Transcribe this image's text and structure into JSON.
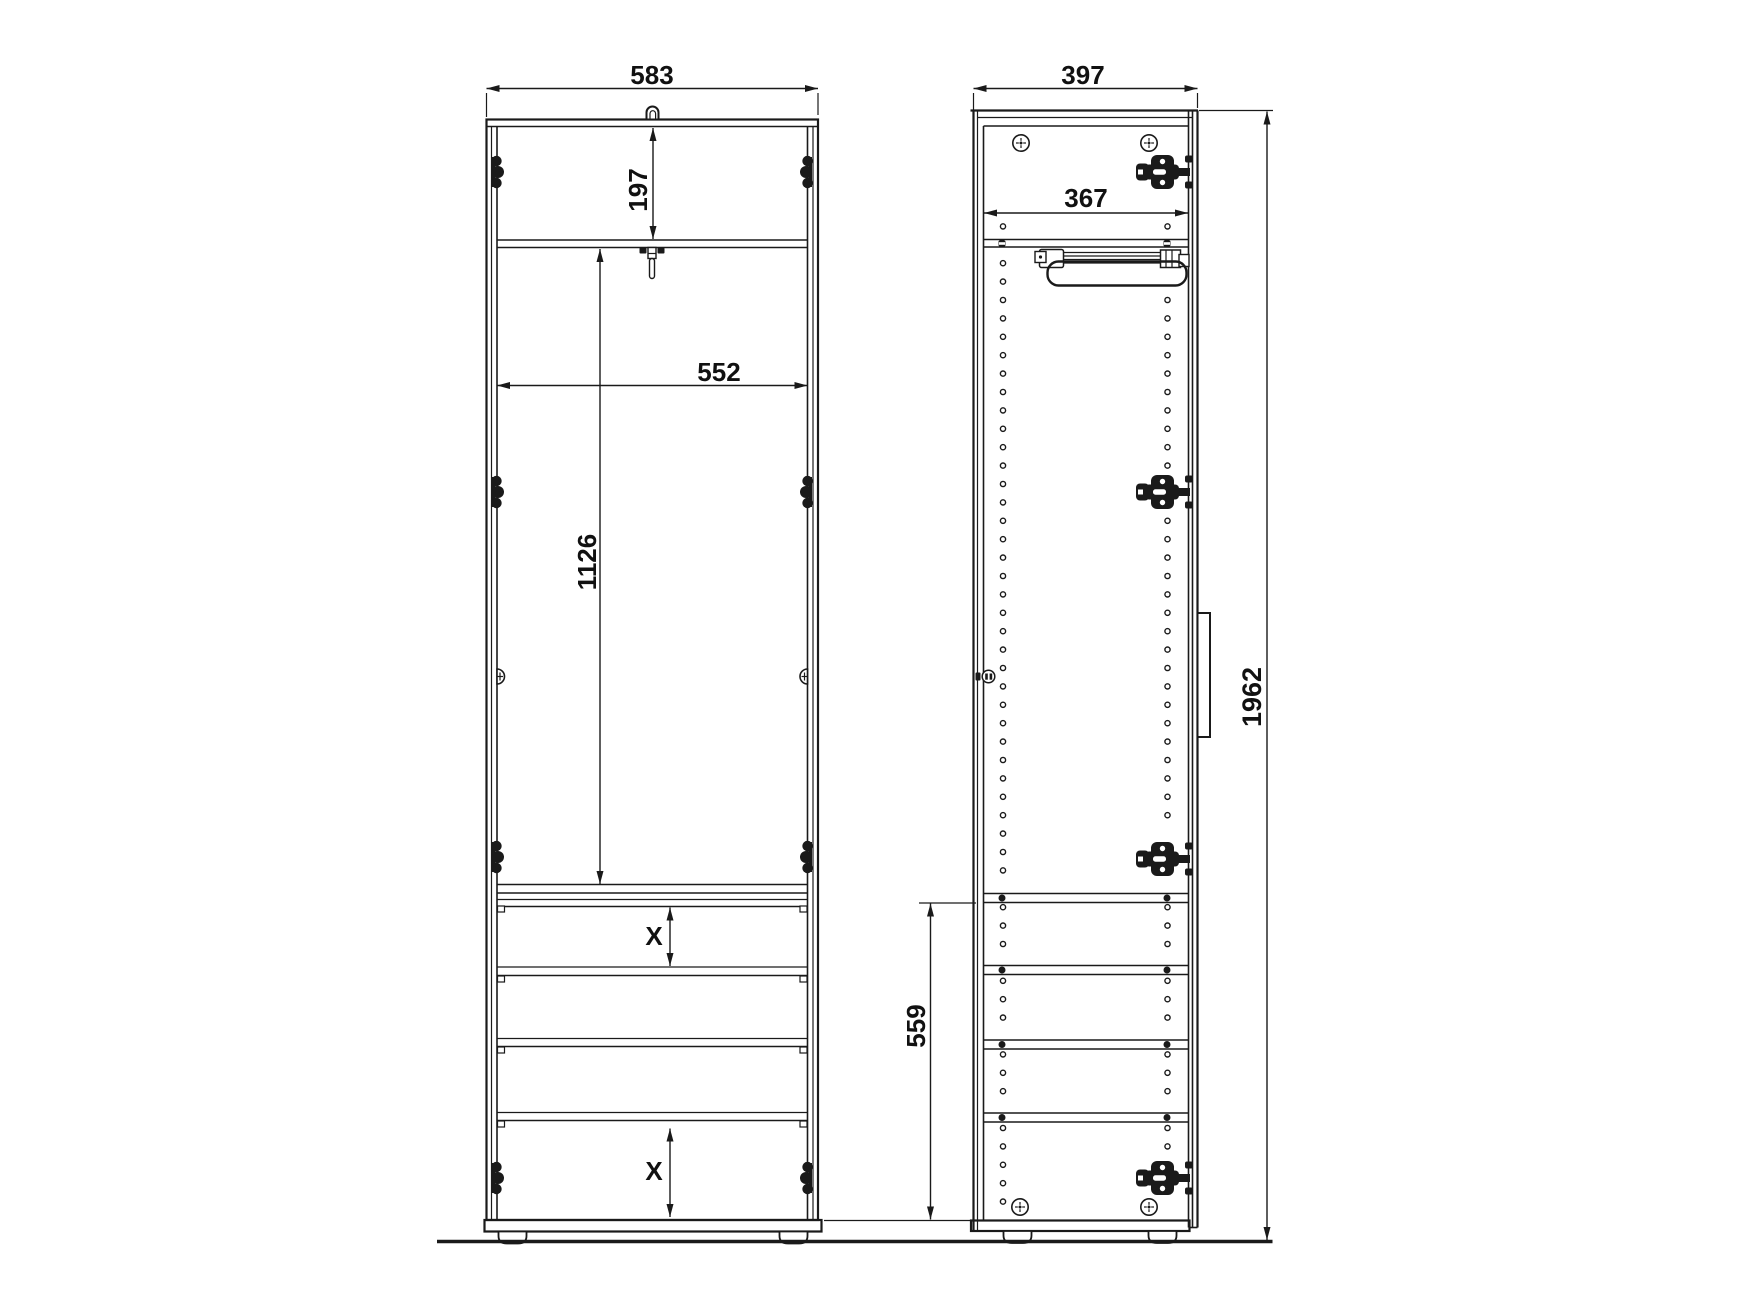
{
  "drawing": {
    "type": "furniture-technical-drawing",
    "background_color": "#ffffff",
    "line_color": "#1a1a1a",
    "views": {
      "front": {
        "name": "wardrobe front elevation",
        "dimensions": {
          "overall_width": "583",
          "top_compartment_height": "197",
          "interior_width": "552",
          "wardrobe_compartment_height": "1126",
          "shelf_spacing_upper": "X",
          "shelf_spacing_lower": "X"
        }
      },
      "side": {
        "name": "wardrobe side section",
        "dimensions": {
          "overall_depth": "397",
          "interior_depth": "367",
          "lower_section_height": "559",
          "overall_height": "1962"
        }
      }
    },
    "hardware": [
      "concealed-hinge",
      "hinge-mount",
      "shelf-pin-holes",
      "euro-screw",
      "pull-out-clothes-rail",
      "door-handle",
      "lock-knob",
      "wall-mount-hook",
      "adjustable-foot",
      "shelf-clip"
    ]
  }
}
